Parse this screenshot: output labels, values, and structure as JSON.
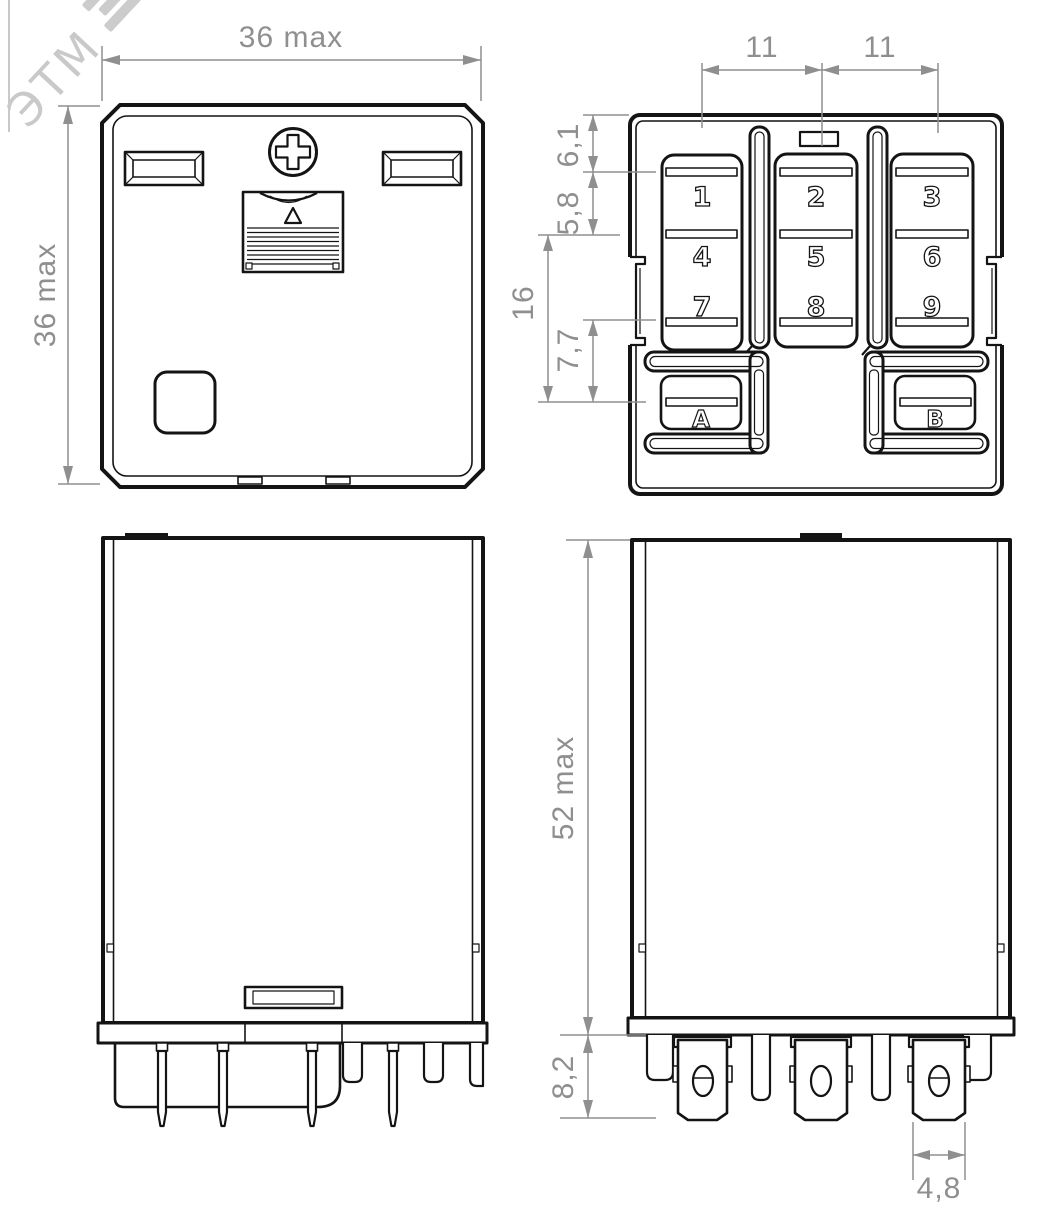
{
  "drawing": {
    "watermark": "ЭТМ",
    "colors": {
      "line": "#141414",
      "dimension": "#8f8f8f",
      "background": "#ffffff",
      "watermark": "#c9c9c9"
    },
    "views": {
      "top": {
        "title": "top-view",
        "dim_width": "36 max",
        "dim_height": "36 max"
      },
      "bottom": {
        "title": "bottom-pin-view",
        "dim_top_left": "11",
        "dim_top_right": "11",
        "dim_chain": {
          "d1": "6,1",
          "d2": "5,8",
          "d3": "16",
          "d4": "7,7"
        },
        "pins": [
          "1",
          "2",
          "3",
          "4",
          "5",
          "6",
          "7",
          "8",
          "9"
        ],
        "coil_terminals": [
          "A",
          "B"
        ]
      },
      "side": {
        "title": "side-view"
      },
      "front": {
        "title": "front-view",
        "dim_height": "52 max",
        "dim_terminal_length": "8,2",
        "dim_blade_width": "4,8"
      }
    }
  }
}
